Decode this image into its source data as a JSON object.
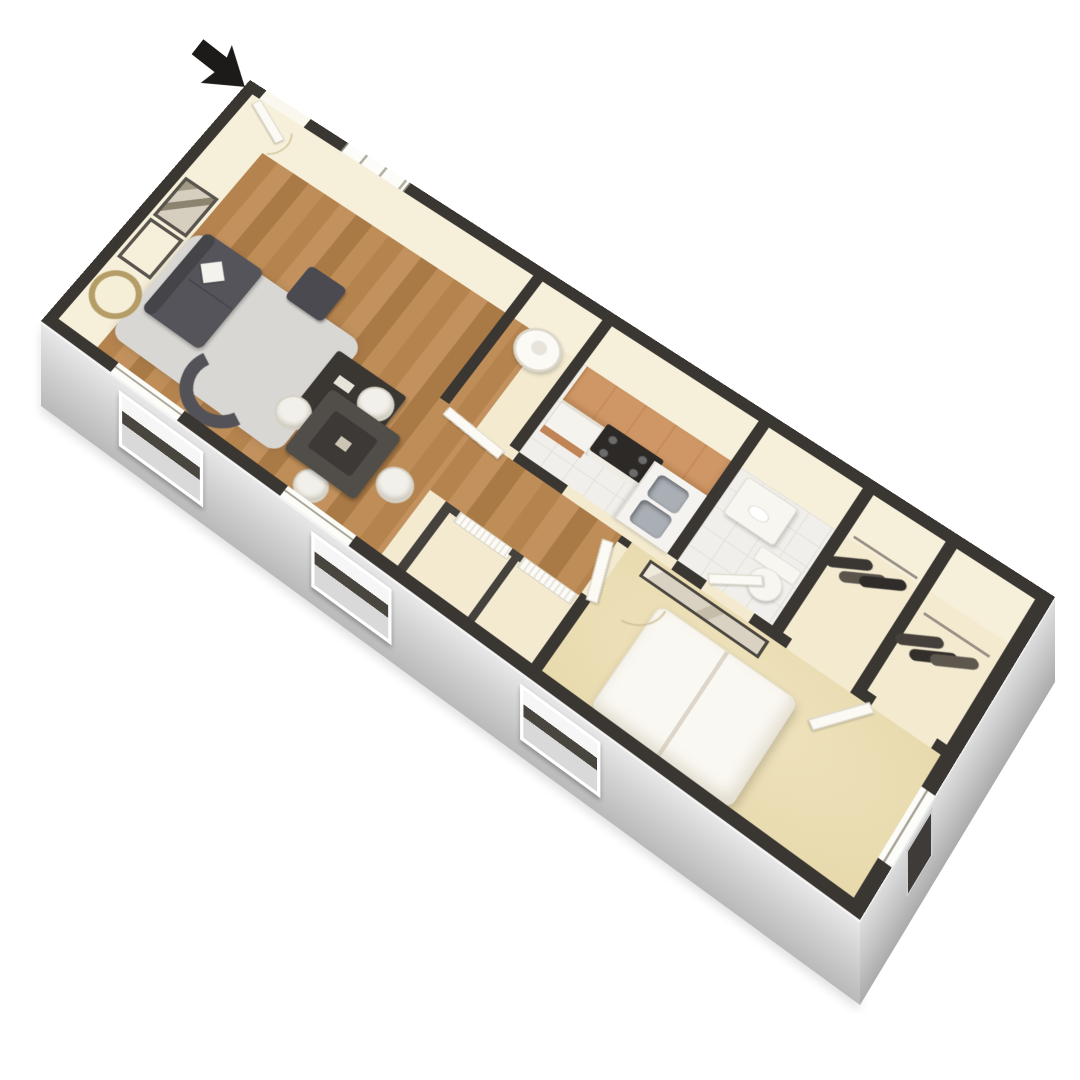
{
  "meta": {
    "title": "3D Floor Plan — One-Bedroom, One-Bath Apartment",
    "style": "isometric dollhouse 3D render, viewed from above at an angle",
    "background": "#ffffff",
    "visible_text": "none — image contains no text labels"
  },
  "entry_arrow": {
    "icon": "entry-arrow",
    "meaning": "entrance indicator pointing at the front door",
    "location": "top-left, outside the unit",
    "color": "#1d1b19"
  },
  "palette": {
    "wall_cap": "#3a3632",
    "interior_wall_cream": "#f3ead0",
    "wood_floor": "#b8854f",
    "bedroom_carpet": "#ecdfb7",
    "tile_floor": "#f1efeb",
    "facade_gray": "#d9d9d9",
    "kitchen_cabinets_orange": "#cf9766",
    "dark_furniture_gray": "#54545a",
    "white_fixtures": "#f8f6f1",
    "rug_gray": "#d9d7d3",
    "mirror_ring_gold": "#b59d68"
  },
  "rooms": [
    {
      "id": "living-room",
      "name": "Living Room",
      "floor": "hardwood",
      "furniture": [
        "dark gray sofa with white throw pillow",
        "dark coffee table with decor",
        "gray area rug",
        "curved dark accent chair",
        "dark ottoman side table",
        "two framed pictures on wall",
        "round gold-ring wall mirror"
      ]
    },
    {
      "id": "dining-area",
      "name": "Dining Area",
      "floor": "hardwood",
      "furniture": [
        "square dark dining table",
        "four white round chairs"
      ]
    },
    {
      "id": "utility-closet",
      "name": "Utility Closet",
      "floor": "tile",
      "furniture": [
        "white cylindrical water heater"
      ]
    },
    {
      "id": "kitchen",
      "name": "Kitchen",
      "floor": "tile",
      "furniture": [
        "orange upper cabinet run",
        "white appliance / dishwasher",
        "black range with white oven front",
        "peninsula counter",
        "stainless double-basin sink",
        "orange lower cabinets"
      ]
    },
    {
      "id": "bathroom",
      "name": "Bathroom",
      "floor": "tile",
      "furniture": [
        "white vanity sink",
        "white toilet"
      ]
    },
    {
      "id": "hall-closets",
      "name": "Hallway Closets",
      "floor": "cream",
      "furniture": [
        "two white louvered doors"
      ]
    },
    {
      "id": "bedroom",
      "name": "Bedroom",
      "floor": "carpet",
      "furniture": [
        "white double bed (two mattress panels)",
        "long framed wall mirror"
      ]
    },
    {
      "id": "closet-1",
      "name": "Bedroom Closet 1",
      "floor": "cream",
      "furniture": [
        "clothes hanging on rod"
      ]
    },
    {
      "id": "closet-2",
      "name": "Bedroom Closet 2",
      "floor": "cream",
      "furniture": [
        "clothes hanging on rod"
      ]
    }
  ],
  "openings": {
    "entry_door": "open door at top-left corner of unit (arrow points to it)",
    "windows_front_facade": 3,
    "window_living_room_rear_wall": 1,
    "window_bedroom_end_wall": 1,
    "interior_doors": [
      "utility-closet door",
      "bathroom door",
      "bedroom door (shown open)",
      "second bedroom door near closets (shown open)",
      "louvered closet doors"
    ]
  }
}
